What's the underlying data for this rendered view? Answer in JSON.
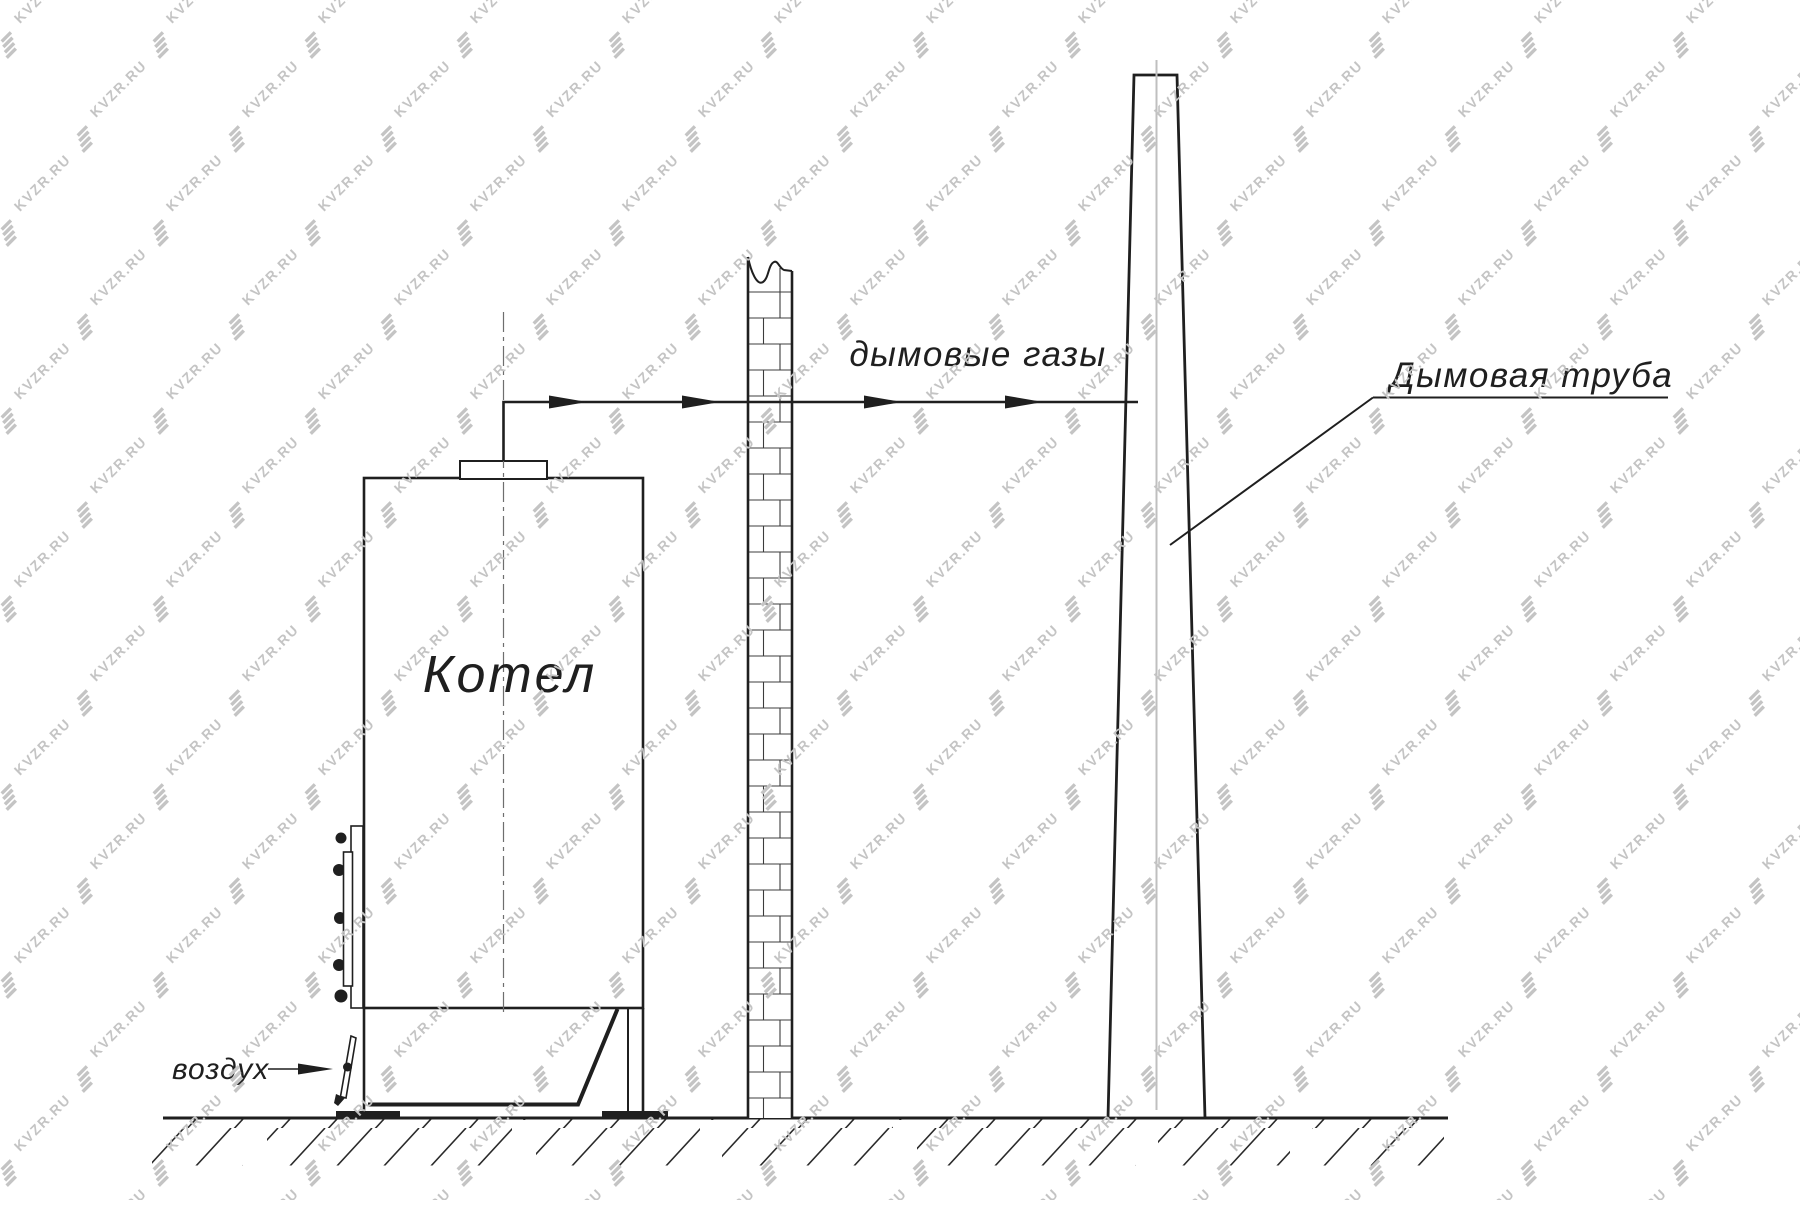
{
  "diagram": {
    "boiler_label": "Котел",
    "flue_gases_label": "дымовые газы",
    "chimney_label": "Дымовая труба",
    "air_label": "воздух"
  },
  "watermark": {
    "text": "KVZR.RU"
  },
  "colors": {
    "line": "#1f1f1f",
    "boiler_centerline": "#6e6e6e",
    "chimney_centerline": "#bfbfbf",
    "watermark": "#c4c4c4",
    "background": "#ffffff"
  }
}
